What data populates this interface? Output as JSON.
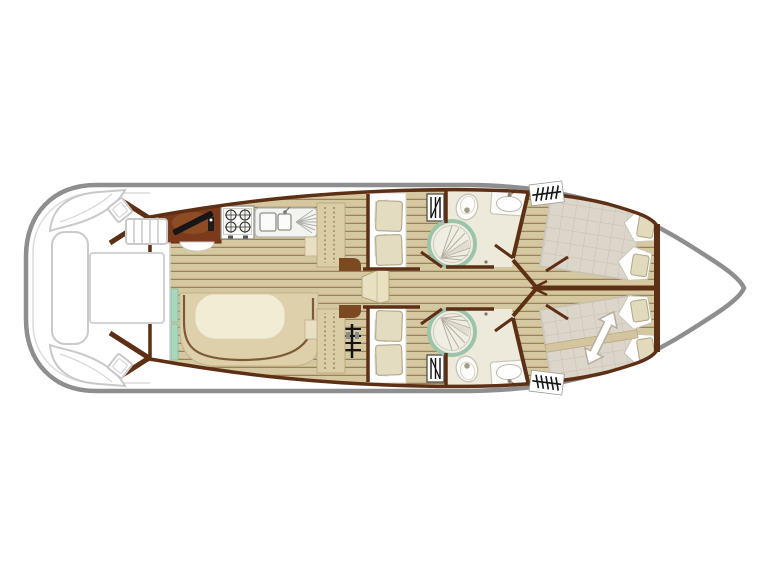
{
  "page": {
    "background_color": "#ffffff",
    "description": "top-view boat floor plan, bow pointing right"
  },
  "colors": {
    "hull_outline": "#8e8e8e",
    "deck_furniture_outline": "#c9c9c9",
    "deck_inner_line": "#dcdcdc",
    "wall_brown": "#5d2f14",
    "floor_plank": "#d5c7a0",
    "floor_plank_line": "#97845a",
    "galley_counter": "#7a3a1b",
    "galley_counter_ellipse": "#8d4c26",
    "black_detail": "#161616",
    "appliance_white": "#f3f3f0",
    "cream_table": "#f2ecd5",
    "bench_tan": "#ddd0ab",
    "bench_outline": "#7c5a36",
    "mint_accent": "#a7d7bd",
    "bathroom_floor": "#edeadb",
    "shower_ring": "#9cc4ab",
    "mattress_quilt": "#dcd5ca",
    "mattress_grid": "#c8bfb4",
    "cushion_beige": "#e4dcc1",
    "cushion_outline": "#b3aa8c",
    "step_cream": "#e9e0c1",
    "shelf_brown": "#7b4a22"
  },
  "plan": {
    "type": "boat-floor-plan",
    "orientation": "bow-right",
    "areas": [
      {
        "name": "aft-deck",
        "fixtures": [
          "corner-seat-port",
          "corner-seat-starboard",
          "side-bench",
          "deck-table",
          "boarding-steps",
          "deck-stool-port",
          "deck-stool-starboard",
          "entry-doors"
        ]
      },
      {
        "name": "saloon-galley",
        "fixtures": [
          "galley-counter",
          "hob-4-burner",
          "double-sink-with-drainer",
          "u-shaped-dinette",
          "dinette-table",
          "storage-columns",
          "companionway-ladder",
          "sliding-door"
        ]
      },
      {
        "name": "mid-cabin-port",
        "fixtures": [
          "single-berth",
          "two-cushions",
          "wardrobe"
        ]
      },
      {
        "name": "mid-cabin-starboard",
        "fixtures": [
          "single-berth",
          "two-cushions",
          "wardrobe"
        ]
      },
      {
        "name": "bathroom-port",
        "fixtures": [
          "corner-shower",
          "toilet",
          "washbasin",
          "hanging-locker"
        ]
      },
      {
        "name": "bathroom-starboard",
        "fixtures": [
          "corner-shower",
          "toilet",
          "washbasin",
          "hanging-locker"
        ]
      },
      {
        "name": "bow-cabin-port",
        "fixtures": [
          "double-berth",
          "two-pillows"
        ]
      },
      {
        "name": "bow-cabin-starboard",
        "fixtures": [
          "sliding-double-berth",
          "two-pillows",
          "slide-direction-arrow"
        ]
      },
      {
        "name": "bow-deck",
        "fixtures": []
      }
    ],
    "counts": {
      "hob_burners": 4,
      "sink_basins": 2,
      "cabins": 4,
      "bathrooms": 2,
      "showers": 2,
      "deck_steps": 4
    }
  }
}
